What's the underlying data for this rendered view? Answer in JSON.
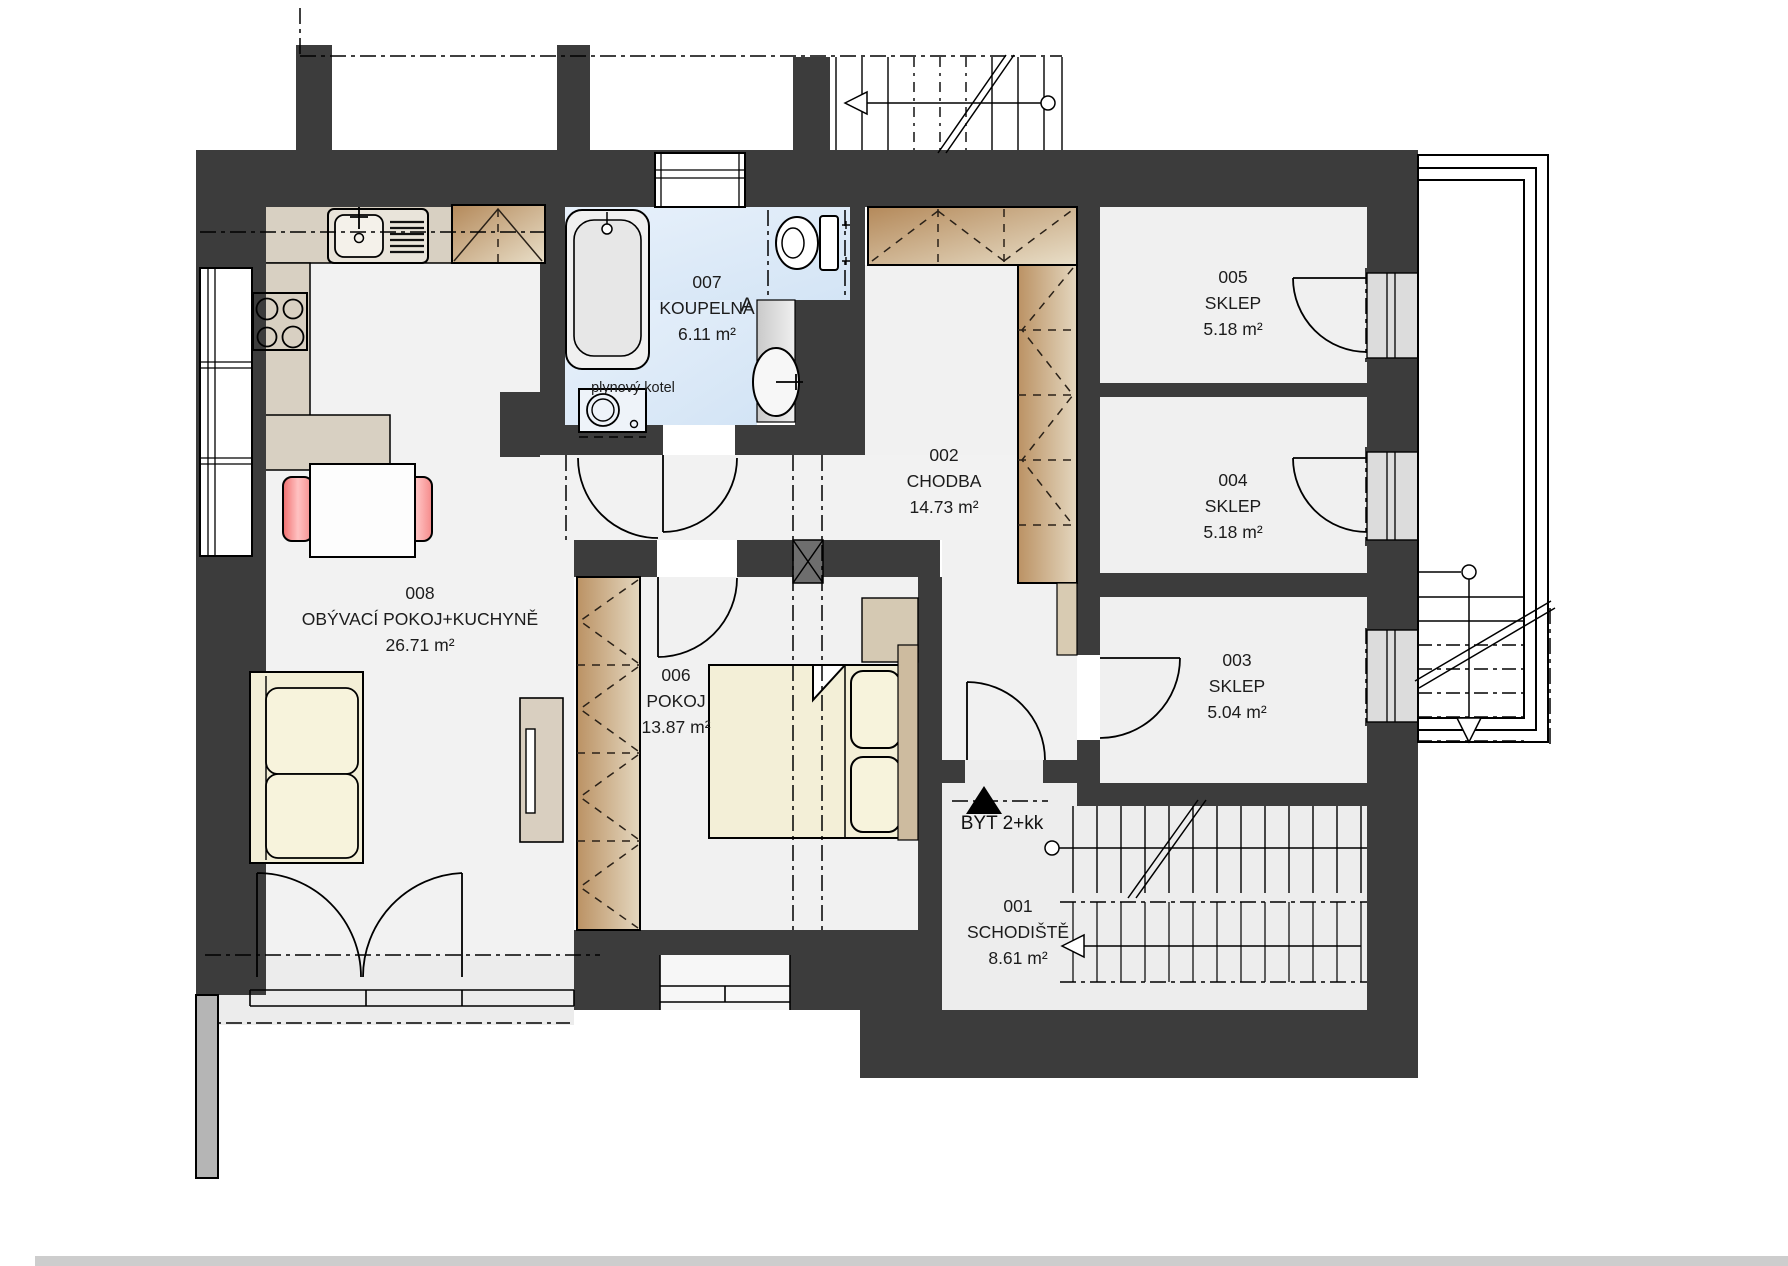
{
  "document": {
    "type": "architectural-floor-plan",
    "floor_unit_label": "BYT 2+kk"
  },
  "rooms": [
    {
      "id": "008",
      "name": "OBÝVACÍ POKOJ+KUCHYNĚ",
      "area": "26.71 m²"
    },
    {
      "id": "007",
      "name": "KOUPELNA",
      "area": "6.11 m²"
    },
    {
      "id": "002",
      "name": "CHODBA",
      "area": "14.73 m²"
    },
    {
      "id": "006",
      "name": "POKOJ",
      "area": "13.87 m²"
    },
    {
      "id": "005",
      "name": "SKLEP",
      "area": "5.18 m²"
    },
    {
      "id": "004",
      "name": "SKLEP",
      "area": "5.18 m²"
    },
    {
      "id": "003",
      "name": "SKLEP",
      "area": "5.04 m²"
    },
    {
      "id": "001",
      "name": "SCHODIŠTĚ",
      "area": "8.61 m²"
    }
  ],
  "annotations": {
    "apartment": "BYT 2+kk",
    "boiler": "plynový kotel",
    "section_marker": "A"
  },
  "colors": {
    "wall": "#3c3c3c",
    "floor": "#f2f2f2",
    "bathroom_floor": "#ddeaf8",
    "wood_dark": "#b98f5c",
    "wood_light": "#e8dcc6",
    "counter": "#d8d0c2",
    "cream_furniture": "#f3efd7",
    "chair_red": "#f58787",
    "door_panel_gray": "#dcdcdc",
    "exterior_gray": "#b5b5b5"
  }
}
